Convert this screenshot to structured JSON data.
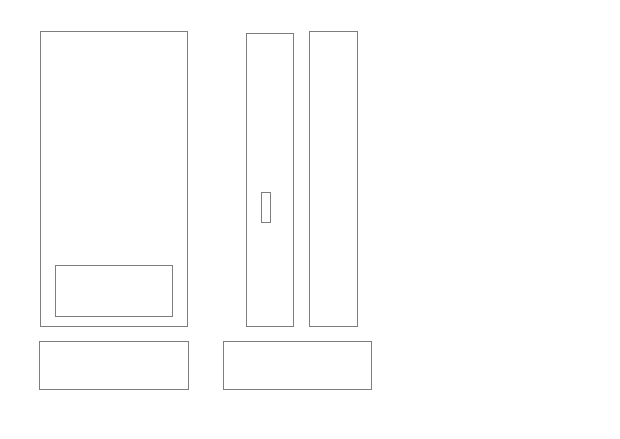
{
  "canvas": {
    "width": 620,
    "height": 439,
    "background_color": "#ffffff"
  },
  "diagram": {
    "description": "furniture-elevation-line-drawing",
    "stroke_color": "#7d7d7d",
    "fill_color": "#ffffff",
    "stroke_width": 1,
    "shapes": [
      {
        "name": "large-cabinet-outline",
        "x": 40,
        "y": 31,
        "w": 148,
        "h": 296
      },
      {
        "name": "large-cabinet-inset-panel",
        "x": 55,
        "y": 265,
        "w": 118,
        "h": 52
      },
      {
        "name": "left-base-outline",
        "x": 39,
        "y": 341,
        "w": 150,
        "h": 49
      },
      {
        "name": "narrow-door-left-outline",
        "x": 246,
        "y": 33,
        "w": 48,
        "h": 294
      },
      {
        "name": "narrow-door-handle",
        "x": 261,
        "y": 192,
        "w": 10,
        "h": 31
      },
      {
        "name": "narrow-door-right-outline",
        "x": 309,
        "y": 31,
        "w": 49,
        "h": 296
      },
      {
        "name": "center-base-outline",
        "x": 223,
        "y": 341,
        "w": 149,
        "h": 49
      }
    ]
  }
}
